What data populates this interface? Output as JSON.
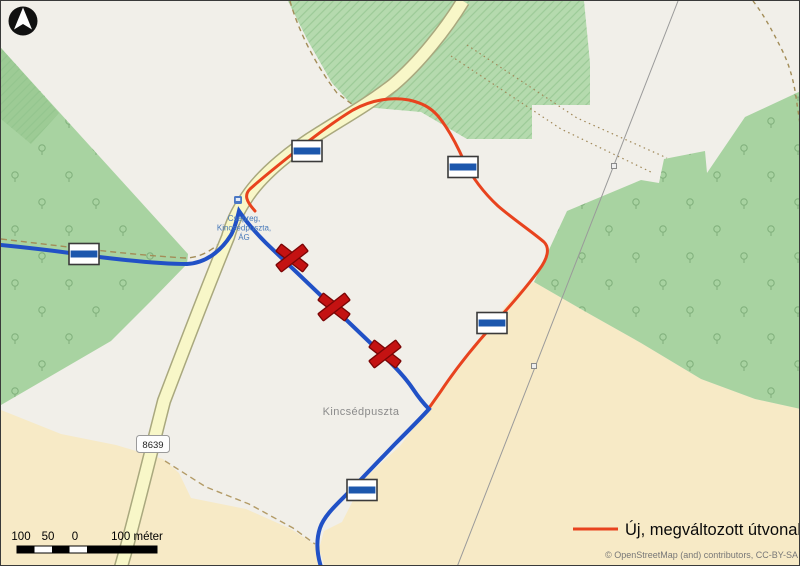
{
  "legend": {
    "label": "Új, megváltozott útvonal",
    "line_color": "#e8431e"
  },
  "attribution": "© OpenStreetMap (and) contributors, CC-BY-SA",
  "scale": {
    "labels": [
      "100",
      "50",
      "0",
      "100 méter"
    ]
  },
  "labels": {
    "place": "Kincsédpuszta",
    "road_ref": "8639",
    "bus_stop": [
      "Csepreg,",
      "Kincsédpuszta,",
      "ÁG"
    ]
  },
  "routes": {
    "new_route_color": "#e8431e",
    "existing_route_color": "#2151c6"
  },
  "symbols": {
    "blaze_stripe_color": "#1c57ad",
    "closed_marker_color": "#c41212",
    "trail_blaze": "blue-stripe trail blaze",
    "closed_marker": "red X closed section marker",
    "blaze_count": 5,
    "closed_count": 3,
    "icons": [
      "north-arrow-icon",
      "trail-blaze-icon",
      "closed-route-x-icon",
      "bus-stop-icon",
      "pylon-icon"
    ]
  }
}
